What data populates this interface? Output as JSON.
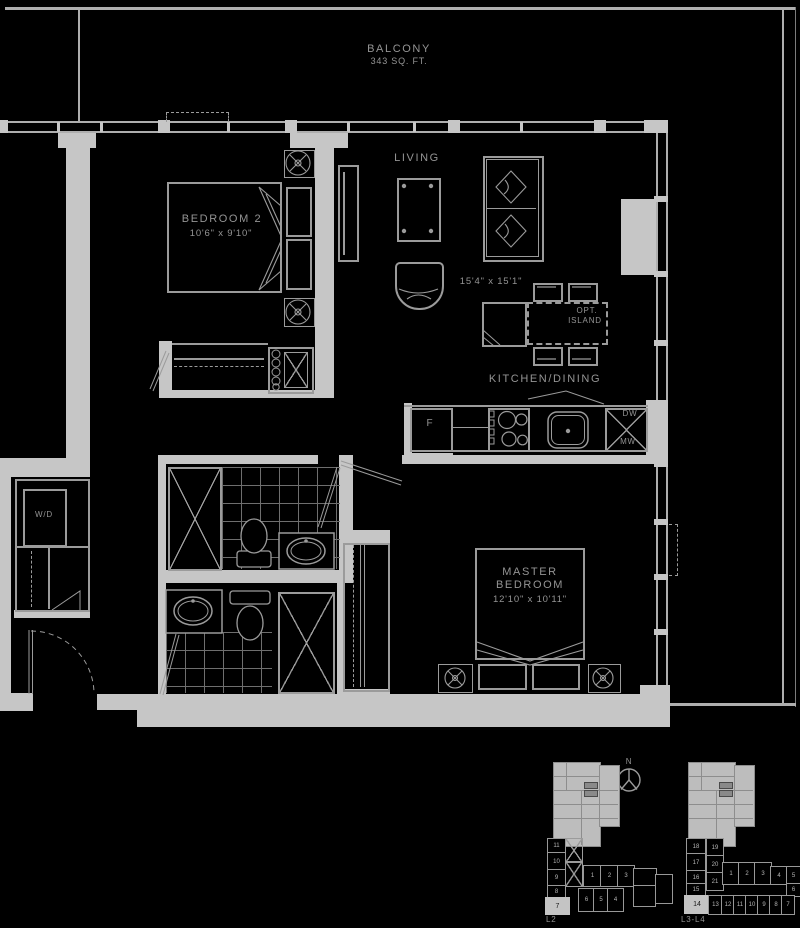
{
  "colors": {
    "background": "#000000",
    "wall": "#c6c6c6",
    "line": "#9b9b9b",
    "label": "#949494",
    "highlight_unit_fill": "#c4c4c4"
  },
  "plan": {
    "balcony": {
      "name": "BALCONY",
      "area": "343 SQ. FT."
    },
    "living": {
      "name": "LIVING",
      "dimensions": "15'4\" x 15'1\""
    },
    "kitchen_dining": {
      "name": "KITCHEN/DINING"
    },
    "optional_island": {
      "line1": "OPT.",
      "line2": "ISLAND"
    },
    "bedroom2": {
      "name": "BEDROOM 2",
      "dimensions": "10'6\" x 9'10\""
    },
    "master_bedroom": {
      "line1": "MASTER",
      "line2": "BEDROOM",
      "dimensions": "12'10\" x 10'11\""
    },
    "laundry": {
      "name": "W/D"
    },
    "appliances": {
      "fridge": "F",
      "dishwasher": "DW",
      "microwave": "MW"
    },
    "north": "N"
  },
  "keyplans": {
    "left": {
      "label": "L2",
      "column_units": [
        "11",
        "10",
        "9",
        "8"
      ],
      "highlighted_unit": "7",
      "top_row_units": [
        "1",
        "2",
        "3"
      ],
      "bottom_row_units": [
        "6",
        "5",
        "4"
      ]
    },
    "right": {
      "label": "L3-L4",
      "column_units": [
        "18",
        "17",
        "16",
        "15"
      ],
      "highlighted_unit": "14",
      "middle_units": [
        "19",
        "20",
        "21"
      ],
      "top_row_units": [
        "1",
        "2",
        "3",
        "4",
        "5"
      ],
      "side_unit": "6",
      "bottom_row_units": [
        "13",
        "12",
        "11",
        "10",
        "9",
        "8",
        "7"
      ]
    }
  }
}
